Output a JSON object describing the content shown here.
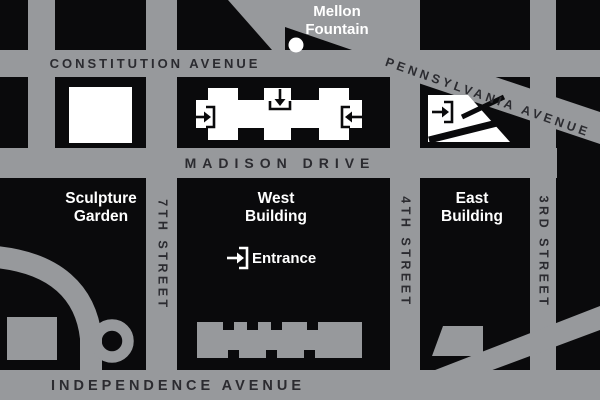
{
  "streets": {
    "constitution": "CONSTITUTION AVENUE",
    "pennsylvania": "PENNSYLVANIA AVENUE",
    "madison": "MADISON DRIVE",
    "independence": "INDEPENDENCE AVENUE",
    "seventh": "7TH STREET",
    "fourth": "4TH STREET",
    "third": "3RD STREET"
  },
  "places": {
    "mellon": [
      "Mellon",
      "Fountain"
    ],
    "sculpture_garden": [
      "Sculpture",
      "Garden"
    ],
    "west_building": [
      "West",
      "Building"
    ],
    "east_building": [
      "East",
      "Building"
    ],
    "entrance": "Entrance"
  },
  "colors": {
    "street_gray": "#97999c",
    "block_black": "#0a0a0c",
    "street_label_dark": "#2b2b30",
    "place_label_white": "#ffffff",
    "building_white": "#ffffff"
  },
  "icons": {
    "entrance_marker": "door-arrow-icon",
    "fountain_marker": "fountain-dot-icon"
  }
}
